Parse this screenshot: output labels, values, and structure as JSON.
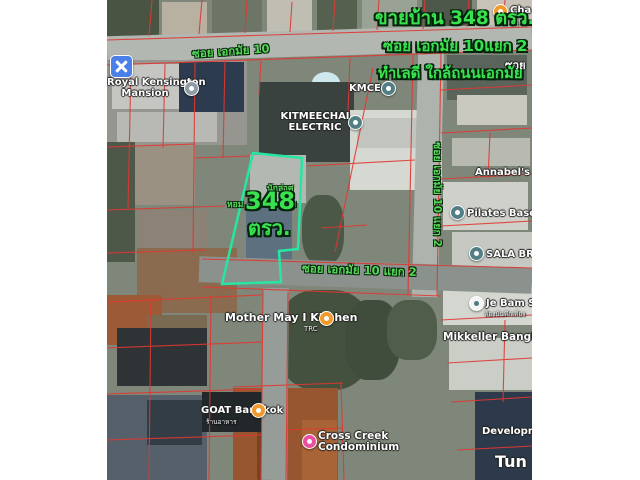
{
  "caption": {
    "line1": "ขายบ้าน 348 ตรว.",
    "line2": "ซอย เอกมัย 10แยก 2",
    "line3": "ทำเลดี ใกล้ถนนเอกมัย",
    "color": "#38e24f"
  },
  "parcel": {
    "outline_color": "#27e6a3",
    "area_value": "348",
    "area_unit": "ตรว.",
    "underlying_label": {
      "top": "นักล่าศ",
      "left": "หอม",
      "right": "เกม"
    }
  },
  "streets": {
    "soi_ekkamai_10": "ซอย เอกมัย 10",
    "soi_ekkamai_10_yaek_2": "ซอย เอกมัย 10 แยก 2",
    "soi_ekkamai_10_yaek_2_vertical": "ซอย เอกมัย 10 แยก 2",
    "soi_edge": "ซอย"
  },
  "pois": {
    "cha": {
      "label": "Cha C",
      "sub": "ญี่ปุ่น"
    },
    "royal_kensington": {
      "label_line1": "Royal Kensington",
      "label_line2": "Mansion"
    },
    "kmce": {
      "label": "KMCE"
    },
    "kitmeechai": {
      "label_line1": "KITMEECHAI",
      "label_line2": "ELECTRIC"
    },
    "annabels": {
      "label": "Annabel's Nu"
    },
    "pilates": {
      "label": "Pilates Base"
    },
    "sala": {
      "label": "SALA BRAN"
    },
    "je_bam": {
      "label": "Je Bam Stu",
      "sub": "ห้องบันทึกเสียง"
    },
    "mikkeller": {
      "label": "Mikkeller Bangkok"
    },
    "mother_may": {
      "label": "Mother May I Kitchen",
      "sub": "TRC"
    },
    "goat": {
      "label": "GOAT Bangkok",
      "sub": "ร้านอาหาร"
    },
    "cross_creek": {
      "label_line1": "Cross Creek",
      "label_line2": "Condominium"
    },
    "development": {
      "label": "Developme"
    },
    "tun": {
      "label": "Tun"
    }
  },
  "colors": {
    "food_marker": "#f09a2d",
    "generic_marker": "#527f85",
    "lodging_marker": "#8f9ba5",
    "pink_marker": "#e94f9e",
    "hardware_icon": "#4a80e8",
    "cadastral_line": "#e23731"
  }
}
